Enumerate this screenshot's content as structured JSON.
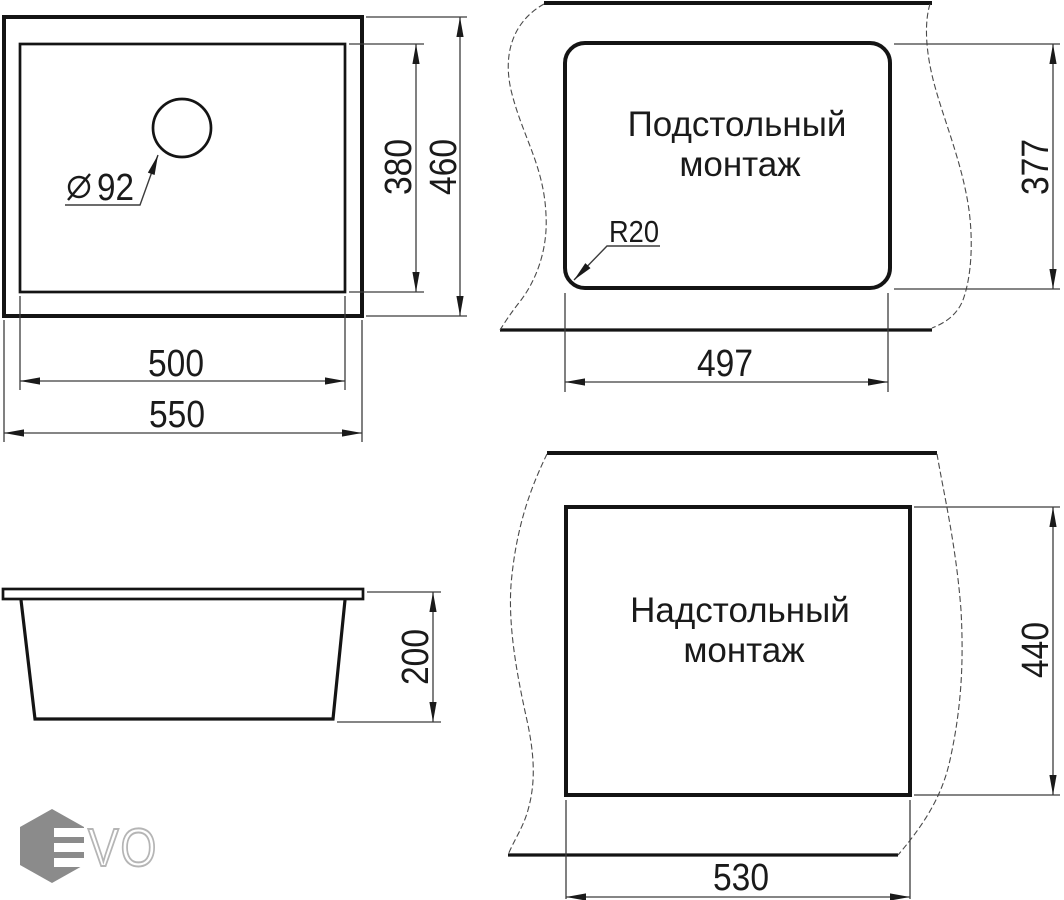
{
  "drawing": {
    "top_view": {
      "hole_diameter": "92",
      "inner_width": "500",
      "outer_width": "550",
      "inner_height": "380",
      "outer_height": "460"
    },
    "undermount_view": {
      "title_line1": "Подстольный",
      "title_line2": "монтаж",
      "corner_radius_label": "R20",
      "cutout_width": "497",
      "cutout_height": "377"
    },
    "side_view": {
      "bowl_depth": "200"
    },
    "overmount_view": {
      "title_line1": "Надстольный",
      "title_line2": "монтаж",
      "cutout_width": "530",
      "cutout_height": "440"
    },
    "logo": {
      "letters": "VO"
    },
    "colors": {
      "object_line": "#141414",
      "dimension_line": "#3c3c3c",
      "text": "#1a1a1a",
      "logo_hexagon": "#8b8b8b",
      "logo_letter_outline": "#b5b5b5",
      "background": "#ffffff"
    }
  }
}
